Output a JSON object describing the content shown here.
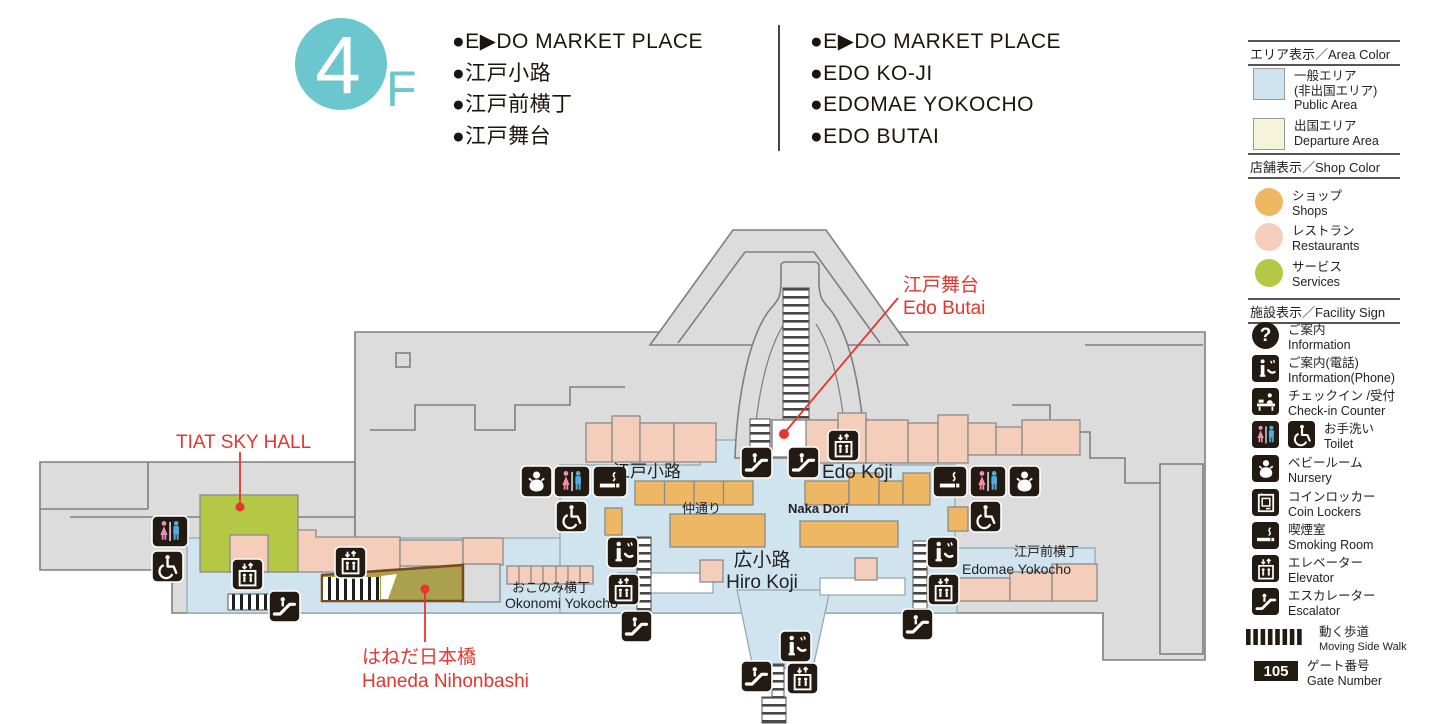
{
  "header": {
    "floor_number": "4",
    "floor_suffix": "F",
    "list_ja": [
      "●E▶DO MARKET PLACE",
      "●江戸小路",
      "●江戸前横丁",
      "●江戸舞台"
    ],
    "list_en": [
      "●E▶DO MARKET PLACE",
      "●EDO KO-JI",
      "●EDOMAE YOKOCHO",
      "●EDO BUTAI"
    ]
  },
  "legend": {
    "area": {
      "title": "エリア表示／Area Color",
      "public": {
        "ja": "一般エリア",
        "ja2": "(非出国エリア)",
        "en": "Public Area",
        "color": "#cfe4ee"
      },
      "departure": {
        "ja": "出国エリア",
        "en": "Departure Area",
        "color": "#f6f4da"
      }
    },
    "shop": {
      "title": "店舗表示／Shop Color",
      "items": [
        {
          "ja": "ショップ",
          "en": "Shops",
          "color": "#eeb763"
        },
        {
          "ja": "レストラン",
          "en": "Restaurants",
          "color": "#f4cdbb"
        },
        {
          "ja": "サービス",
          "en": "Services",
          "color": "#b5c846"
        }
      ]
    },
    "facility": {
      "title": "施設表示／Facility Sign",
      "question_mark": "?",
      "items": [
        {
          "icon": "information",
          "ja": "ご案内",
          "en": "Information"
        },
        {
          "icon": "information-phone",
          "ja": "ご案内(電話)",
          "en": "Information(Phone)"
        },
        {
          "icon": "check-in",
          "ja": "チェックイン /受付",
          "en": "Check-in Counter"
        },
        {
          "icon": "toilet-wheelchair",
          "ja": "お手洗い",
          "en": "Toilet"
        },
        {
          "icon": "nursery",
          "ja": "ベビールーム",
          "en": "Nursery"
        },
        {
          "icon": "coin-locker",
          "ja": "コインロッカー",
          "en": "Coin Lockers"
        },
        {
          "icon": "smoking",
          "ja": "喫煙室",
          "en": "Smoking Room"
        },
        {
          "icon": "elevator",
          "ja": "エレベーター",
          "en": "Elevator"
        },
        {
          "icon": "escalator",
          "ja": "エスカレーター",
          "en": "Escalator"
        },
        {
          "icon": "moving-walk",
          "ja": "動く歩道",
          "en": "Moving Side Walk"
        },
        {
          "icon": "gate-number",
          "ja": "ゲート番号",
          "en": "Gate Number",
          "badge": "105"
        }
      ]
    }
  },
  "map": {
    "areas": {
      "edo_koji": {
        "ja": "江戸小路",
        "en": "Edo Koji"
      },
      "naka_dori": {
        "ja": "仲通り",
        "en": "Naka Dori"
      },
      "hiro_koji": {
        "ja": "広小路",
        "en": "Hiro Koji"
      },
      "okonomi_yokocho": {
        "ja": "おこのみ横丁",
        "en": "Okonomi Yokocho"
      },
      "edomae_yokocho": {
        "ja": "江戸前横丁",
        "en": "Edomae Yokocho"
      }
    },
    "callouts": {
      "edo_butai": {
        "ja": "江戸舞台",
        "en": "Edo Butai"
      },
      "tiat_sky_hall": {
        "en": "TIAT SKY HALL"
      },
      "haneda_nihonbashi": {
        "ja": "はねだ日本橋",
        "en": "Haneda Nihonbashi"
      }
    },
    "colors": {
      "public_area": "#cfe4ee",
      "building_gray": "#dcdcdc",
      "shops": "#eeb763",
      "restaurants": "#f4cdbb",
      "services": "#b5c846",
      "bridge": "#aba04b",
      "callout_red": "#e5352c",
      "icon_black": "#231a12",
      "floor_teal": "#6cc6ce"
    }
  }
}
